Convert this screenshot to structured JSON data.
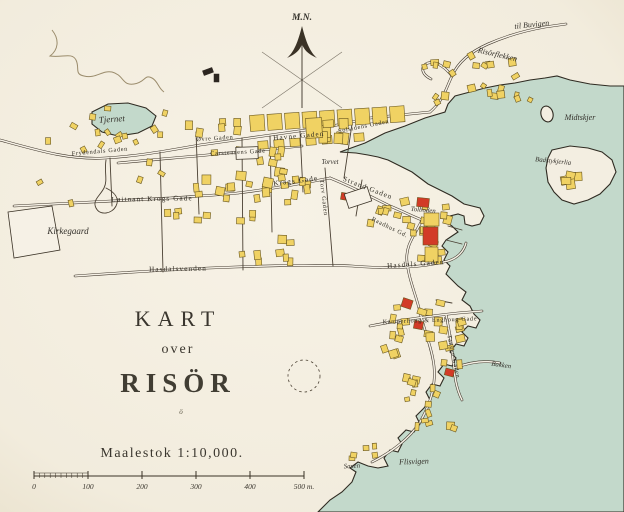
{
  "map_title": {
    "line1": "KART",
    "line2": "over",
    "line3": "RISÖR",
    "ornament": "ö"
  },
  "scale": {
    "text": "Maalestok 1:10,000.",
    "ticks": [
      "0",
      "100",
      "200",
      "300",
      "400",
      "500 m."
    ]
  },
  "compass": {
    "label": "M.N."
  },
  "colors": {
    "paper": "#f3eee1",
    "paperlight": "#f6f1e6",
    "water": "#c3d9cb",
    "building": "#f0d263",
    "building_red": "#d23b27",
    "ink": "#3a3226"
  },
  "labels": [
    {
      "text": "M.N.",
      "x": 302,
      "y": 20,
      "rot": 0,
      "cls": "compass"
    },
    {
      "text": "til Buvigen",
      "x": 532,
      "y": 27,
      "rot": -6,
      "cls": "place-sm"
    },
    {
      "text": "Risörflekken",
      "x": 497,
      "y": 57,
      "rot": 13,
      "cls": "place-sm"
    },
    {
      "text": "Midtskjer",
      "x": 580,
      "y": 120,
      "rot": 0,
      "cls": "place-sm"
    },
    {
      "text": "Badstykjerlia",
      "x": 553,
      "y": 163,
      "rot": 6,
      "cls": "place-xs"
    },
    {
      "text": "Tjernet",
      "x": 112,
      "y": 122,
      "rot": -4,
      "cls": "place"
    },
    {
      "text": "Frydendals Gaden",
      "x": 100,
      "y": 153,
      "rot": -5,
      "cls": "street-xs"
    },
    {
      "text": "Øvre Gaden",
      "x": 215,
      "y": 140,
      "rot": -4,
      "cls": "street-xs"
    },
    {
      "text": "Havne Gaden",
      "x": 299,
      "y": 138,
      "rot": -5,
      "cls": "street"
    },
    {
      "text": "Solsidens Gaden",
      "x": 364,
      "y": 128,
      "rot": -11,
      "cls": "street-xs"
    },
    {
      "text": "Carstensens Gade",
      "x": 238,
      "y": 154,
      "rot": -3,
      "cls": "street-xs"
    },
    {
      "text": "Løitnant Krogs Gade",
      "x": 152,
      "y": 201,
      "rot": -1,
      "cls": "street"
    },
    {
      "text": "Krags Gade",
      "x": 296,
      "y": 183,
      "rot": -7,
      "cls": "street"
    },
    {
      "text": "Kirkegaard",
      "x": 68,
      "y": 234,
      "rot": 0,
      "cls": "place"
    },
    {
      "text": "Torvet",
      "x": 330,
      "y": 164,
      "rot": 0,
      "cls": "place-xs"
    },
    {
      "text": "Torv Gaden",
      "x": 322,
      "y": 198,
      "rot": 83,
      "cls": "street-xs"
    },
    {
      "text": "Strand Gaden",
      "x": 367,
      "y": 190,
      "rot": 21,
      "cls": "street"
    },
    {
      "text": "Tolboden",
      "x": 423,
      "y": 212,
      "rot": 5,
      "cls": "place-xs"
    },
    {
      "text": "Raadhus Gd.",
      "x": 389,
      "y": 229,
      "rot": 26,
      "cls": "street-xs"
    },
    {
      "text": "Hasdals Gaden",
      "x": 416,
      "y": 266,
      "rot": -4,
      "cls": "street"
    },
    {
      "text": "Hasdalsvenden",
      "x": 178,
      "y": 271,
      "rot": -1,
      "cls": "street"
    },
    {
      "text": "Kamperhoug & Enghoug Gade",
      "x": 430,
      "y": 322,
      "rot": -2,
      "cls": "street-xs"
    },
    {
      "text": "Tangen Gaden",
      "x": 452,
      "y": 357,
      "rot": 78,
      "cls": "street-xs"
    },
    {
      "text": "Bakken",
      "x": 501,
      "y": 367,
      "rot": 8,
      "cls": "place-xs"
    },
    {
      "text": "Saxen",
      "x": 352,
      "y": 468,
      "rot": -3,
      "cls": "place-xs"
    },
    {
      "text": "Flisvigen",
      "x": 414,
      "y": 464,
      "rot": -2,
      "cls": "place-sm"
    }
  ]
}
